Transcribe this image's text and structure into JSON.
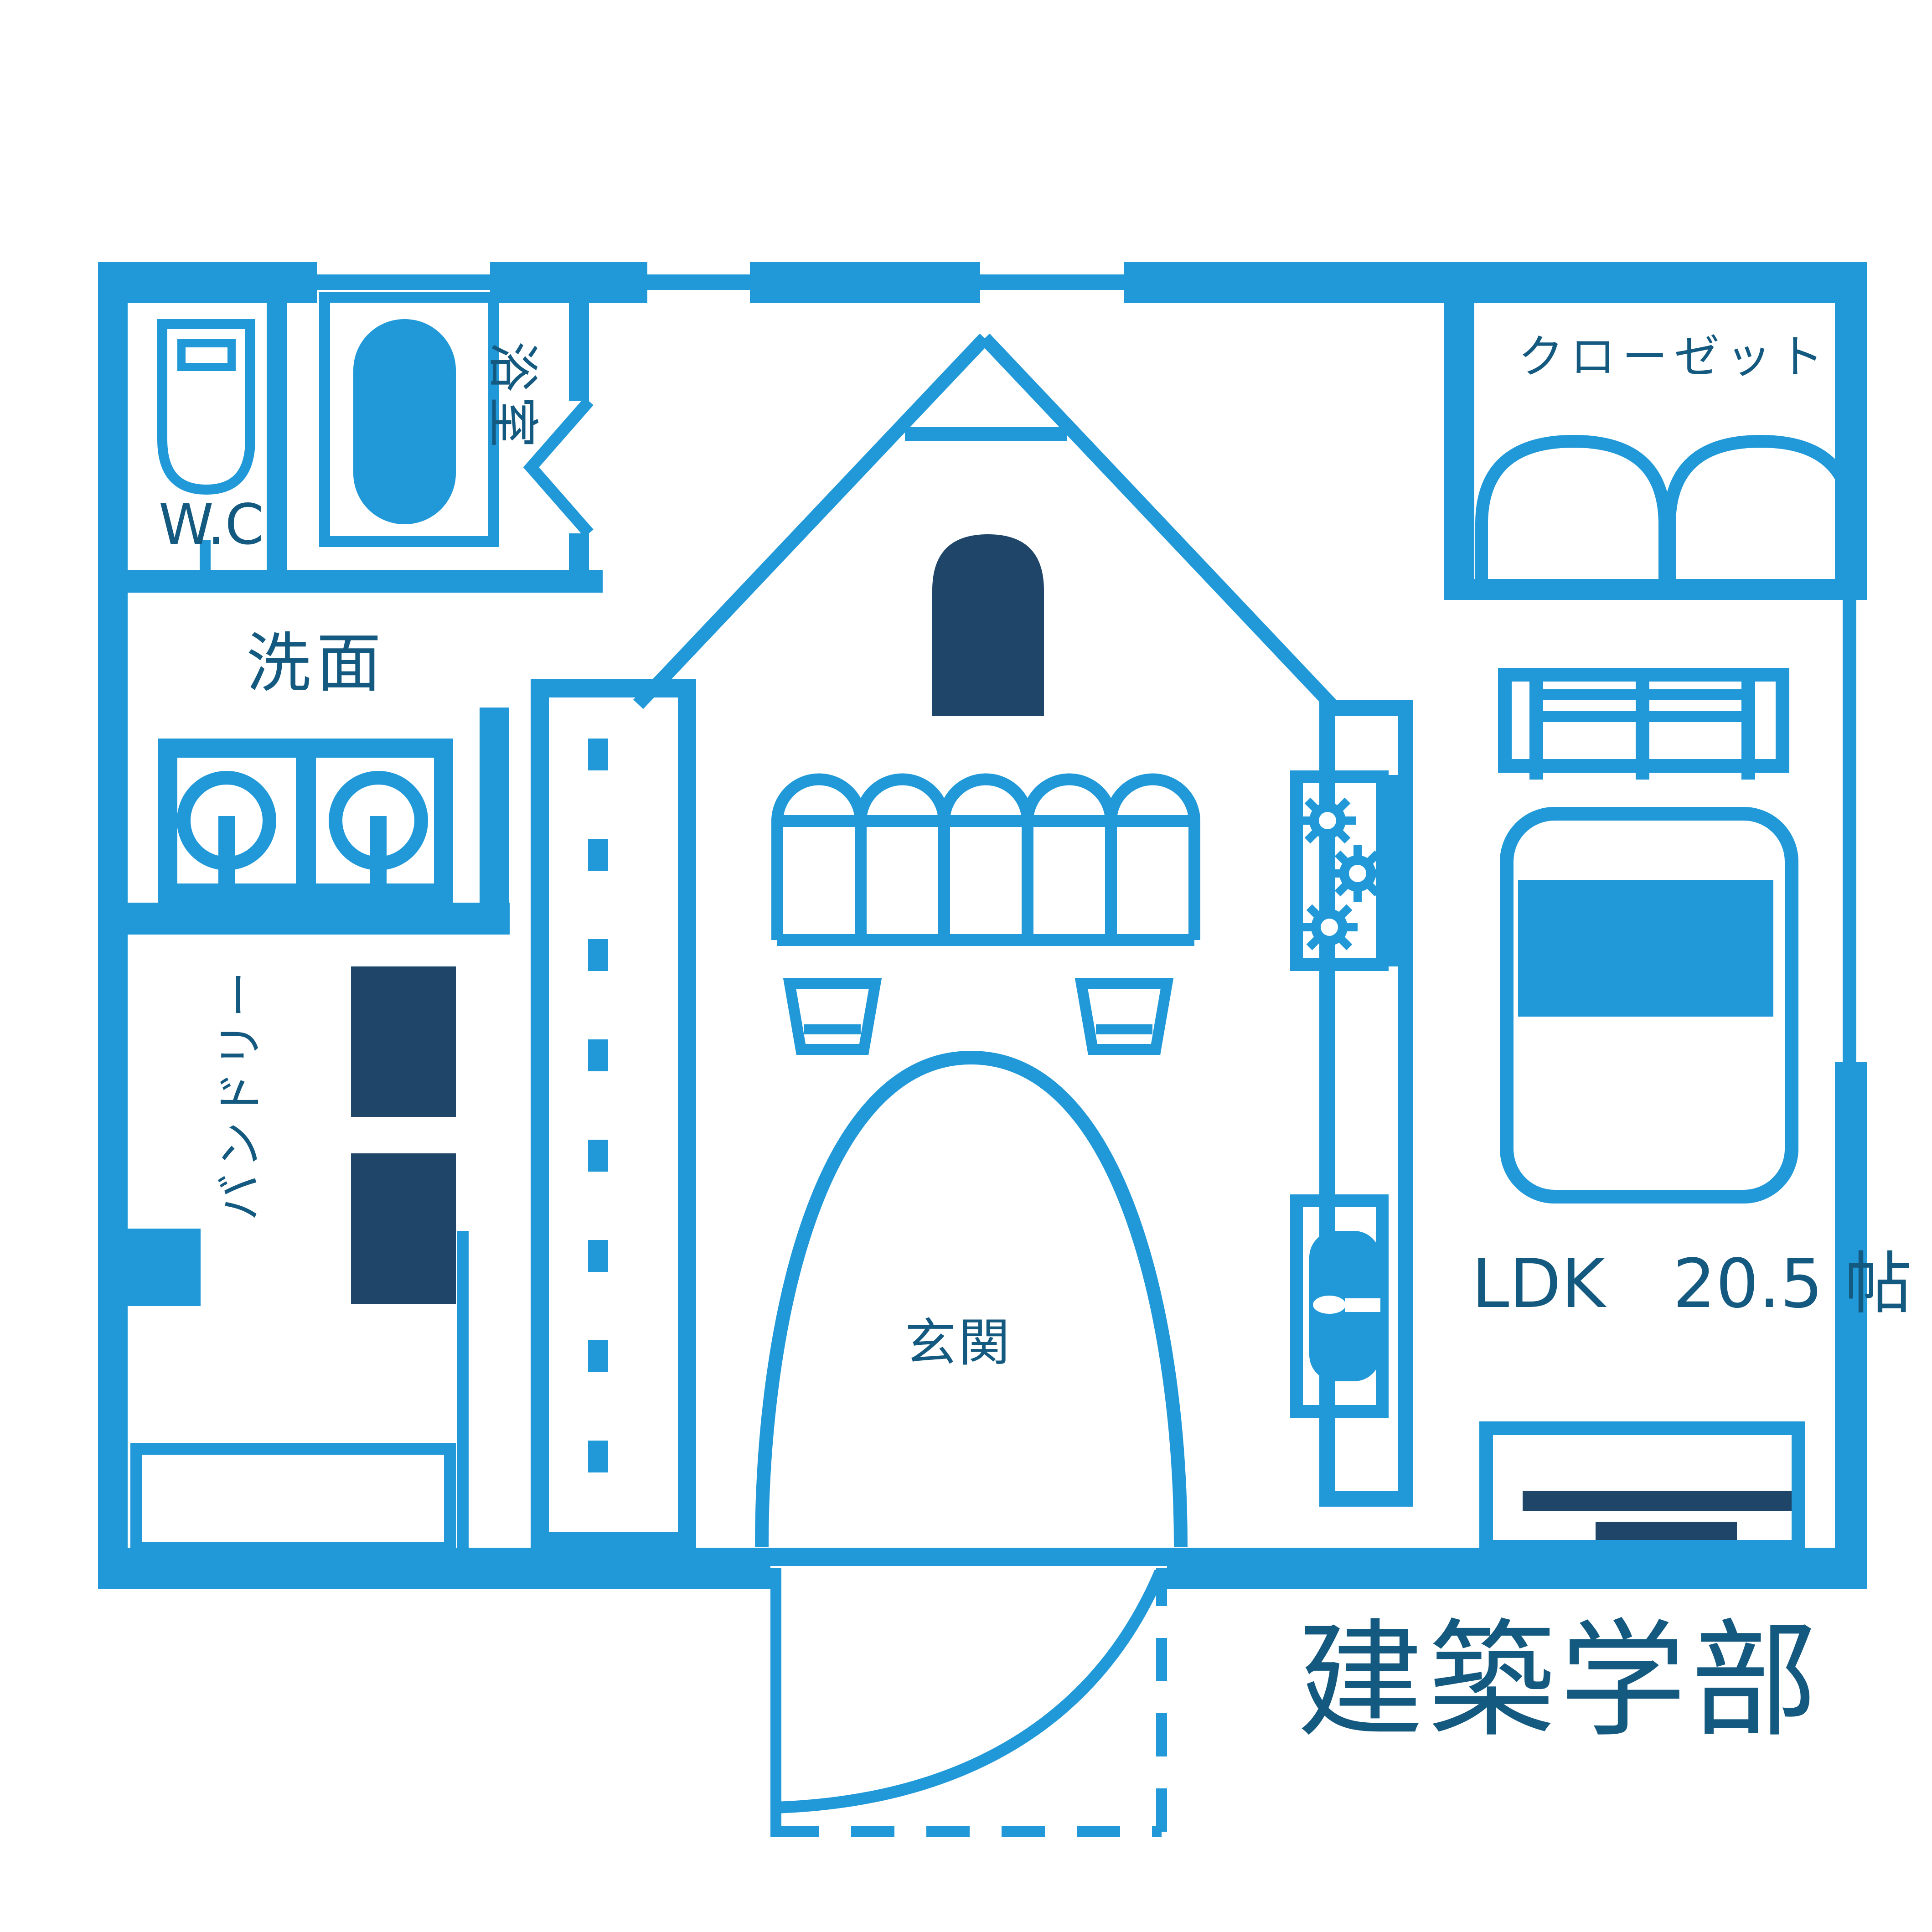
{
  "title": "建築学部 間取り図",
  "colors": {
    "accent": "#2199d8",
    "navy": "#1f4568",
    "label": "#14597f",
    "background": "#ffffff"
  },
  "plan": {
    "rooms": {
      "wc": {
        "label": "W.C"
      },
      "bathroom": {
        "label": "浴室"
      },
      "washroom": {
        "label": "洗面"
      },
      "laundry": {
        "label": "バンドリー"
      },
      "closet": {
        "label": "クローゼット"
      },
      "entrance": {
        "label": "玄関"
      },
      "ldk": {
        "label": "LDK　20.5 帖"
      }
    },
    "caption": "建築学部"
  },
  "icons": {
    "toilet": "toilet-icon",
    "bathtub": "bathtub-icon",
    "sink_left": "sink-icon",
    "sink_right": "sink-icon",
    "washer_upper": "washer-square-icon",
    "washer_lower": "washer-square-icon",
    "closet_doors": "double-door-icon",
    "house_window": "arched-window-icon",
    "awning": "awning-icon",
    "lamp_left": "lamp-icon",
    "lamp_right": "lamp-icon",
    "entrance_arch": "arch-door-icon",
    "door_swing": "door-swing-icon",
    "stove": "stove-burners-icon",
    "kitchen_sink": "kitchen-sink-icon",
    "window_sideboard": "window-icon",
    "bed": "bed-icon",
    "tv_board": "tv-board-icon"
  }
}
